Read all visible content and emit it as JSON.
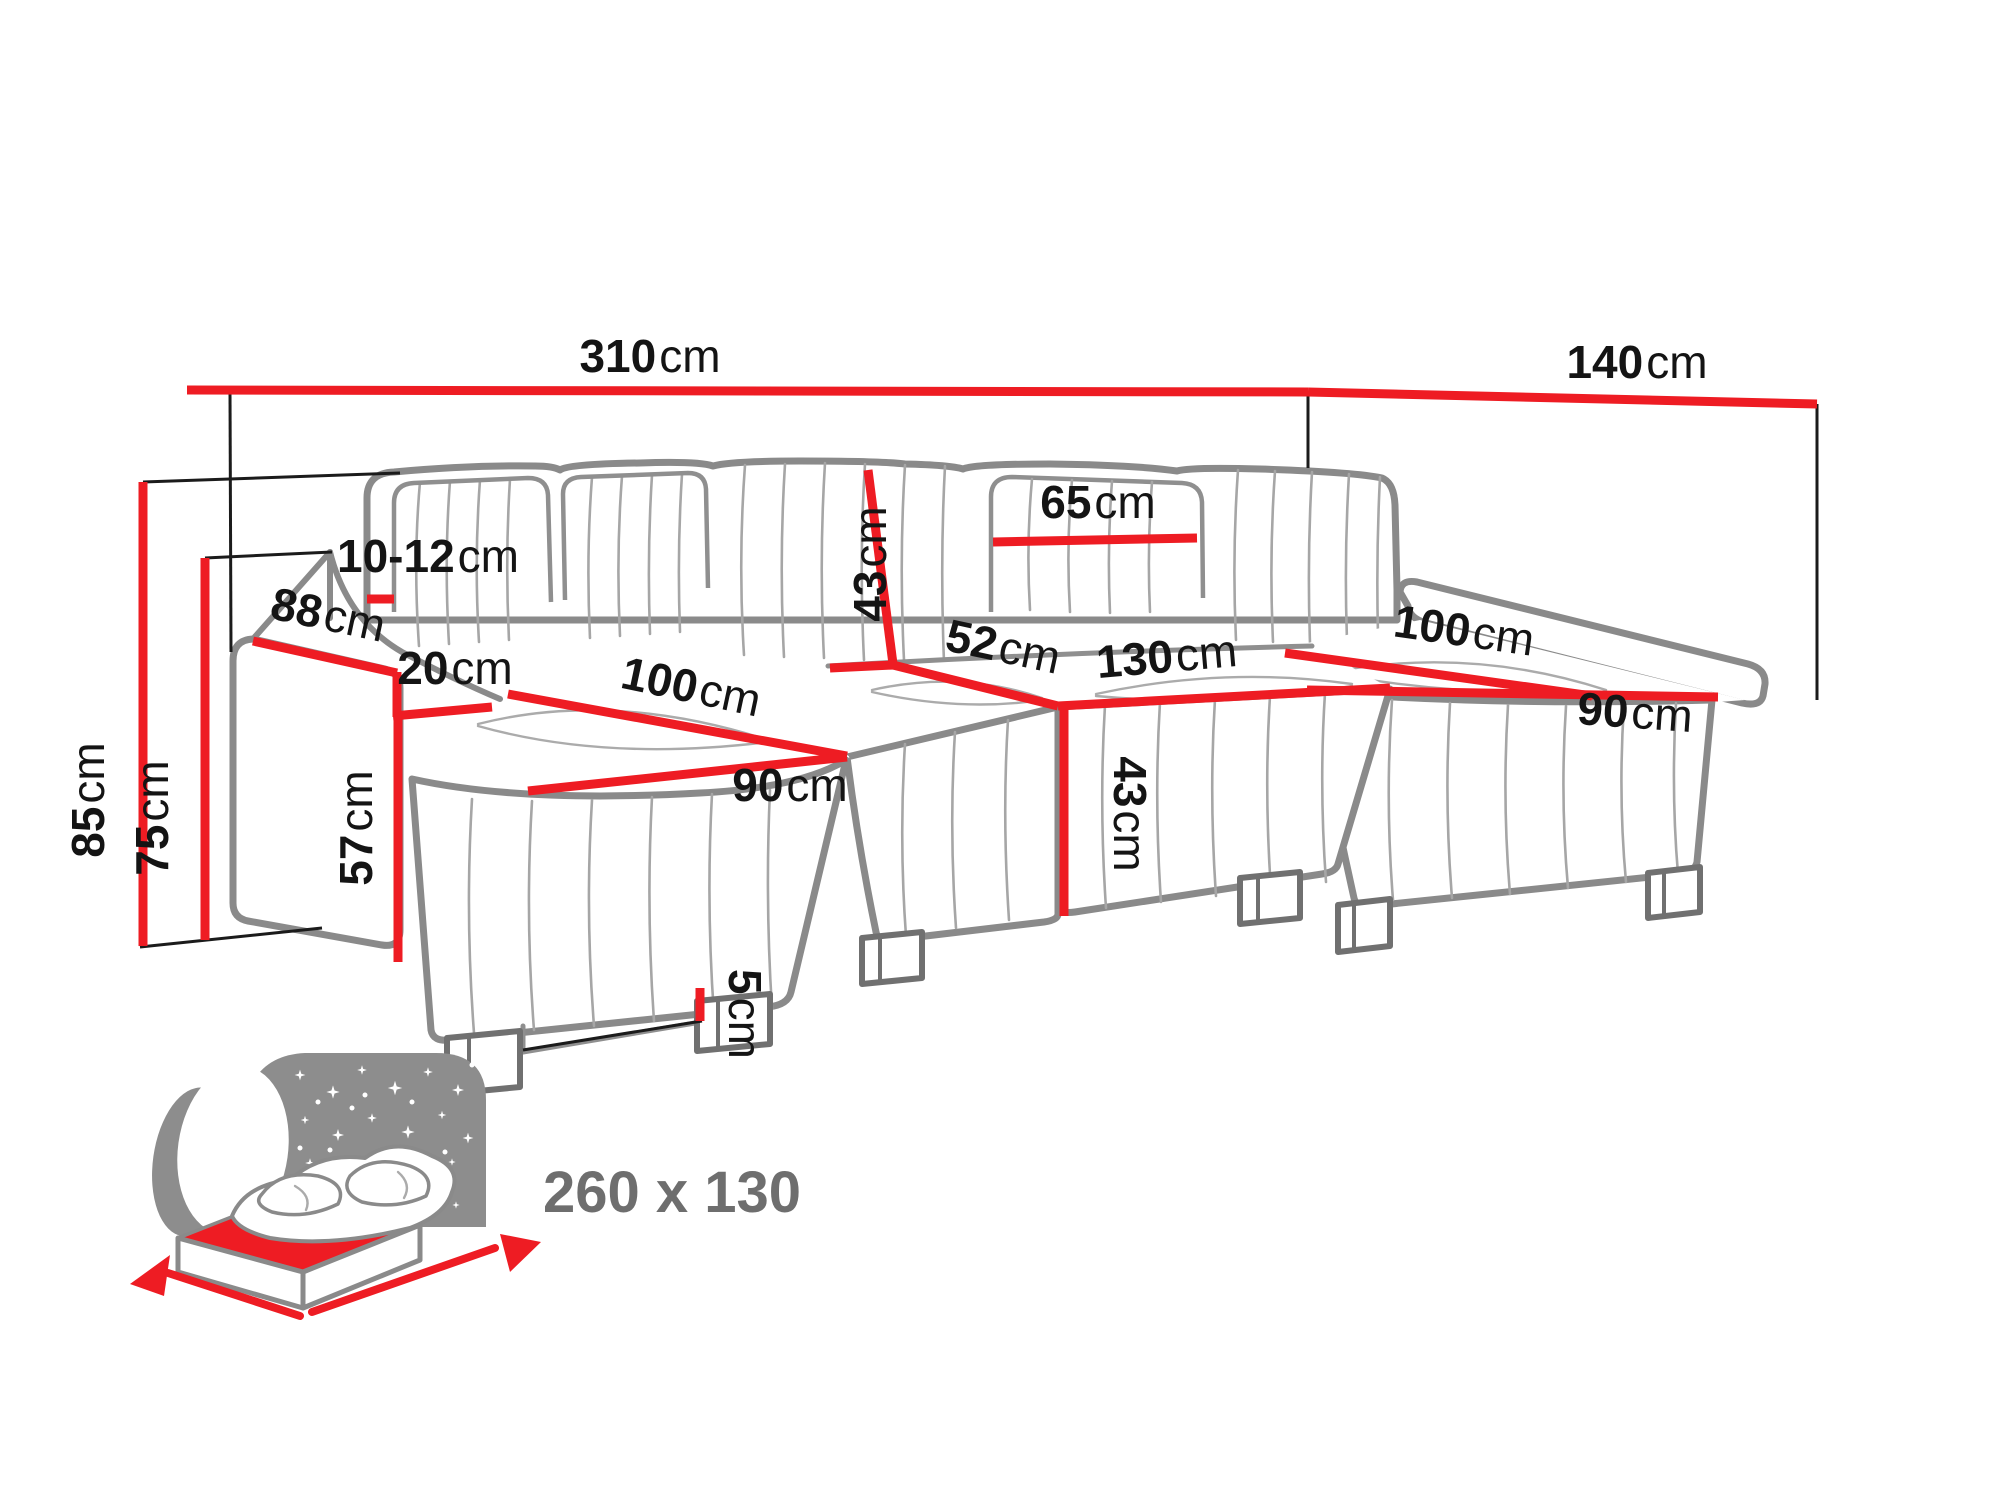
{
  "diagram": {
    "type": "furniture-dimension-diagram",
    "subject": "U-shaped sectional sofa with sleeping function"
  },
  "labels": {
    "total_width": {
      "value": "310",
      "unit": "cm"
    },
    "total_depth": {
      "value": "140",
      "unit": "cm"
    },
    "overall_height": {
      "value": "85",
      "unit": "cm"
    },
    "armrest_height": {
      "value": "75",
      "unit": "cm"
    },
    "armrest_length": {
      "value": "88",
      "unit": "cm"
    },
    "backrest_gap": {
      "value": "10-12",
      "unit": "cm"
    },
    "armrest_width": {
      "value": "20",
      "unit": "cm"
    },
    "left_chaise_length": {
      "value": "100",
      "unit": "cm"
    },
    "left_chaise_width": {
      "value": "90",
      "unit": "cm"
    },
    "side_height": {
      "value": "57",
      "unit": "cm"
    },
    "leg_height": {
      "value": "5",
      "unit": "cm"
    },
    "backrest_height": {
      "value": "43",
      "unit": "cm"
    },
    "seat_depth": {
      "value": "52",
      "unit": "cm"
    },
    "back_cushion_width": {
      "value": "65",
      "unit": "cm"
    },
    "middle_seat_width": {
      "value": "130",
      "unit": "cm"
    },
    "seat_height": {
      "value": "43",
      "unit": "cm"
    },
    "right_chaise_length": {
      "value": "100",
      "unit": "cm"
    },
    "right_chaise_width": {
      "value": "90",
      "unit": "cm"
    }
  },
  "sleeping_function": {
    "dimensions_label": "260 x 130"
  },
  "icons": {
    "sleeping_function": "bed-under-starry-night-with-moon"
  },
  "colors": {
    "dimension_line": "#ee1c23",
    "sofa_outline": "#8a8a8a",
    "label_text": "#141414",
    "sleeping_text": "#6e6e6e",
    "icon_gray": "#8d8d8d"
  }
}
